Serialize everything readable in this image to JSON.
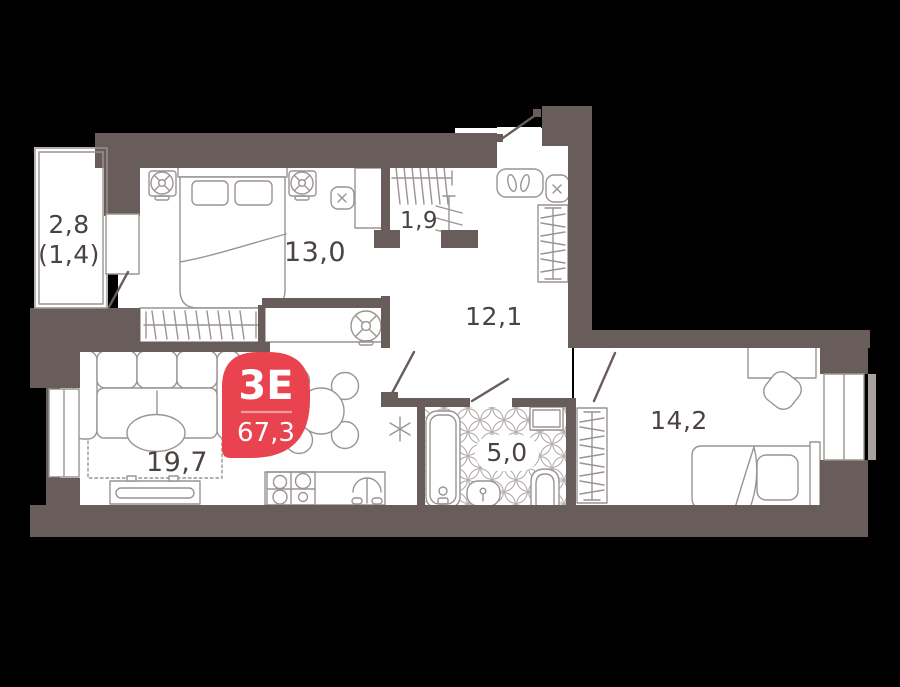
{
  "floor_plan": {
    "badge": {
      "layout_label": "3Е",
      "total_area": "67,3"
    },
    "rooms": {
      "balcony": {
        "area": "2,8",
        "reduced_area": "(1,4)"
      },
      "bedroom_main": {
        "area": "13,0"
      },
      "wardrobe": {
        "area": "1,9"
      },
      "hallway": {
        "area": "12,1"
      },
      "living_kitchen": {
        "area": "19,7"
      },
      "bathroom": {
        "area": "5,0"
      },
      "bedroom_second": {
        "area": "14,2"
      }
    },
    "colors": {
      "background": "#000000",
      "wall": "#695d5c",
      "room": "#ffffff",
      "furniture_line": "#9a9492",
      "label_text": "#4a4340",
      "badge_red": "#e8434e",
      "badge_divider": "#f19ba0",
      "window_reveal": "#a7a19f"
    }
  }
}
